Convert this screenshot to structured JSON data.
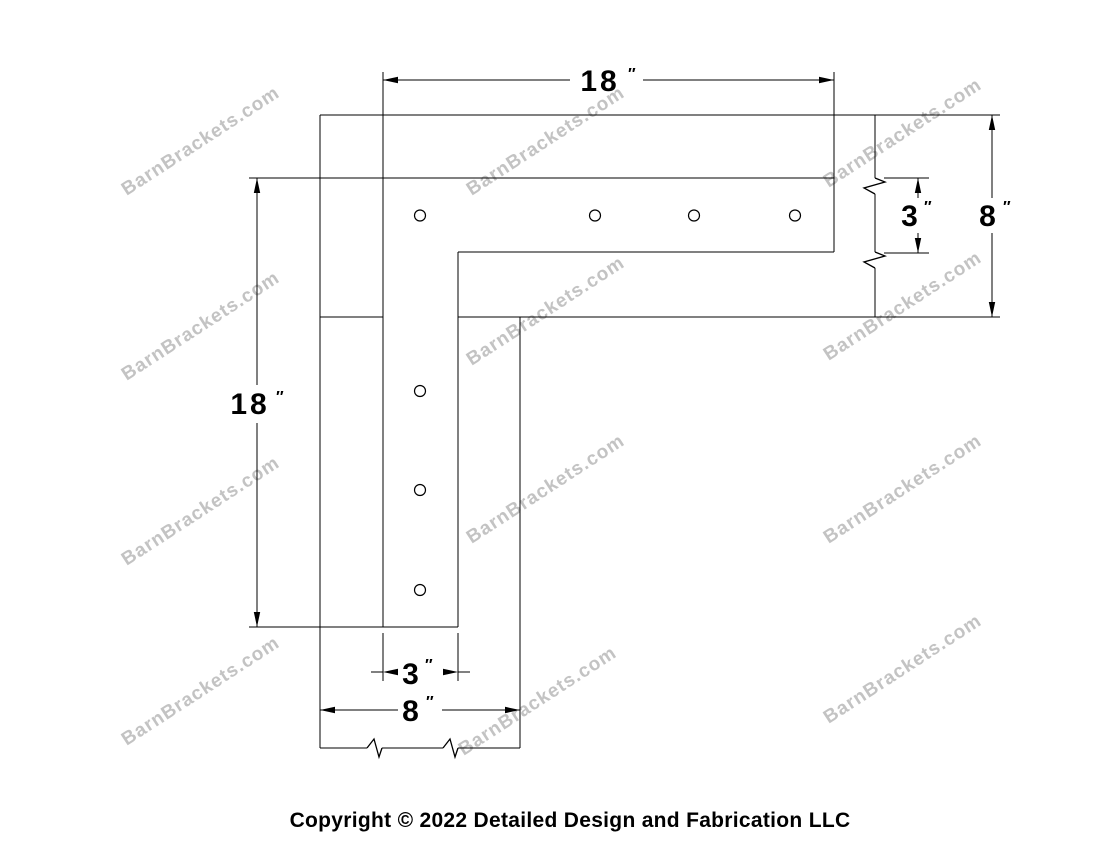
{
  "title": "L shaped timber bracket shop drawing",
  "watermark": {
    "text": "BarnBrackets.com",
    "color": "#c3c3c3"
  },
  "footer": {
    "copyright": "Copyright © 2022 Detailed Design and Fabrication LLC"
  },
  "dimensions": {
    "strap_length_top": {
      "value": "18",
      "unit": "″"
    },
    "strap_length_left": {
      "value": "18",
      "unit": "″"
    },
    "strap_width_right": {
      "value": "3",
      "unit": "″"
    },
    "beam_depth_right": {
      "value": "8",
      "unit": "″"
    },
    "strap_width_bottom": {
      "value": "3",
      "unit": "″"
    },
    "beam_width_bottom": {
      "value": "8",
      "unit": "″"
    }
  },
  "drawing": {
    "line_color": "#000000",
    "bolt_hole_count": 7,
    "break_mark_count": 4
  }
}
